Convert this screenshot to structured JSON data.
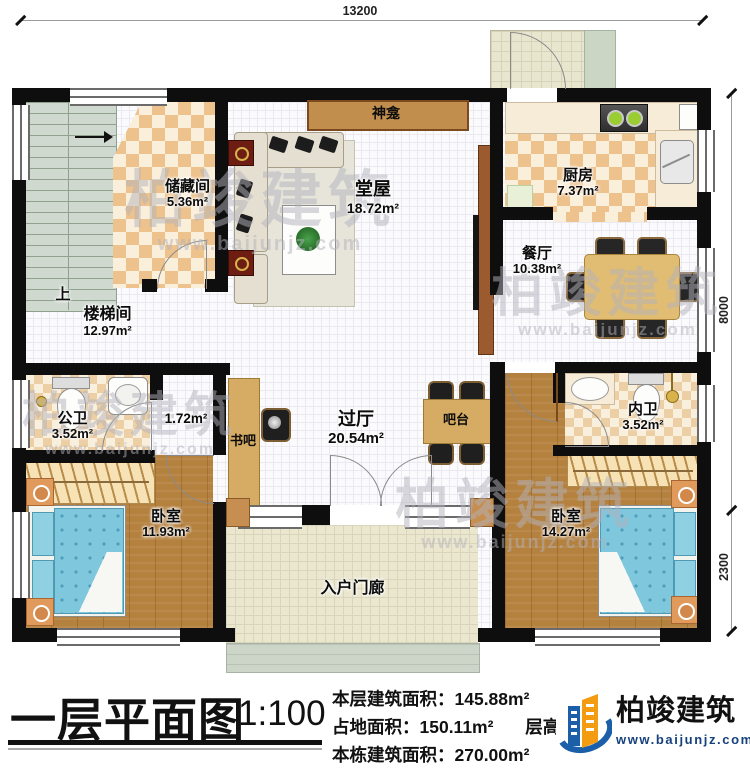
{
  "dims": {
    "top": "13200",
    "right_upper": "8000",
    "right_lower": "2300"
  },
  "rooms": {
    "storage": {
      "name": "储藏间",
      "area": "5.36m²"
    },
    "shrine": {
      "name": "神龛"
    },
    "hall": {
      "name": "堂屋",
      "area": "18.72m²"
    },
    "kitchen": {
      "name": "厨房",
      "area": "7.37m²"
    },
    "dining": {
      "name": "餐厅",
      "area": "10.38m²"
    },
    "stairwell": {
      "name": "楼梯间",
      "area": "12.97m²",
      "up": "上"
    },
    "public_bath": {
      "name": "公卫",
      "area": "3.52m²"
    },
    "closet": {
      "area": "1.72m²"
    },
    "bookbar": {
      "name": "书吧"
    },
    "foyer": {
      "name": "过厅",
      "area": "20.54m²"
    },
    "bar": {
      "name": "吧台"
    },
    "inner_bath": {
      "name": "内卫",
      "area": "3.52m²"
    },
    "bedroom1": {
      "name": "卧室",
      "area": "11.93m²"
    },
    "bedroom2": {
      "name": "卧室",
      "area": "14.27m²"
    },
    "porch": {
      "name": "入户门廊"
    }
  },
  "title_block": {
    "title": "一层平面图",
    "scale": "1:100",
    "floor_area_label": "本层建筑面积：",
    "floor_area_value": "145.88m²",
    "land_area_label": "占地面积：",
    "land_area_value": "150.11m²",
    "height_label": "层高：",
    "total_area_label": "本栋建筑面积：",
    "total_area_value": "270.00m²"
  },
  "brand": {
    "name": "柏竣建筑",
    "url": "www.baijunjz.com"
  },
  "watermark": {
    "text": "柏竣建筑",
    "url": "www.baijunjz.com"
  }
}
